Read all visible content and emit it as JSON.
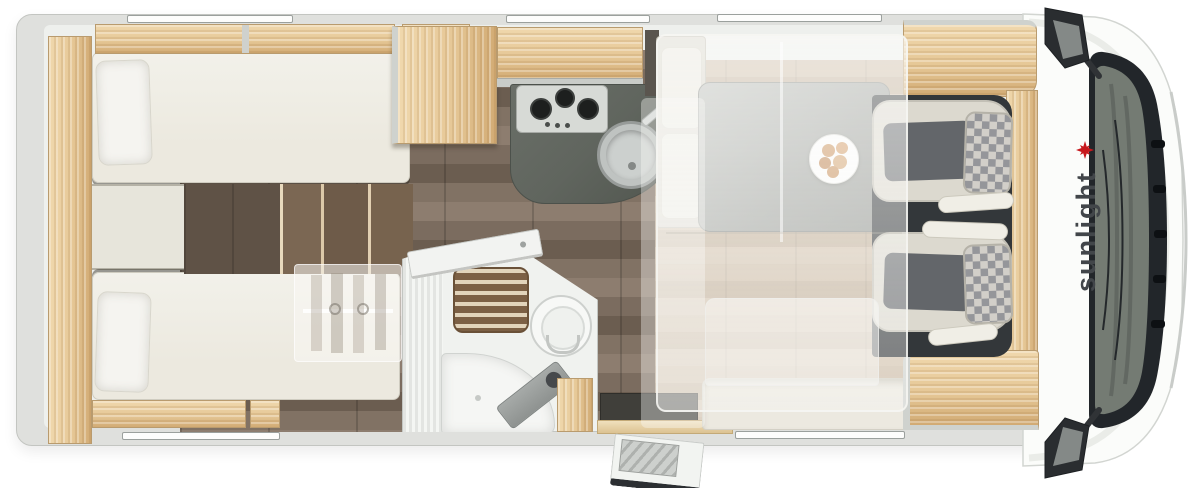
{
  "meta": {
    "view": "motorhome-floorplan-top-view"
  },
  "cab": {
    "logo_text": "sunlight",
    "logo_text_color": "#42464a",
    "logo_sun_color": "#c7181d"
  },
  "colors": {
    "wood": "#e6c897",
    "wood_dark": "#d2ab74",
    "upholstery_cream": "#ece9df",
    "wall_gray": "#dfe0dd",
    "corridor_floor": "#7b6c5f",
    "lounge_floor": "#c2b09a",
    "kitchen_counter": "#60655e",
    "cab_floor": "#33373a",
    "seat_checker_light": "#d2cfc9",
    "seat_checker_dark": "#95969a",
    "windshield_glass": "#747b73",
    "grille": "#0d1013"
  },
  "areas": [
    "rear-twin-bed-top",
    "rear-twin-bed-bottom",
    "center-steps",
    "wardrobe-overlay",
    "overhead-lockers",
    "tall-cabinet",
    "kitchen-counter",
    "gas-hob",
    "kitchen-sink",
    "bathroom",
    "shower-grate",
    "toilet",
    "washbasin",
    "bathroom-door",
    "entry-door",
    "entry-step",
    "half-dinette-bench",
    "dinette-table",
    "food-plate",
    "side-sofa",
    "drop-down-bed-overlay",
    "swivel-cab-seats",
    "cab-windshield",
    "side-mirrors",
    "sunlight-logo",
    "roof-windows"
  ]
}
